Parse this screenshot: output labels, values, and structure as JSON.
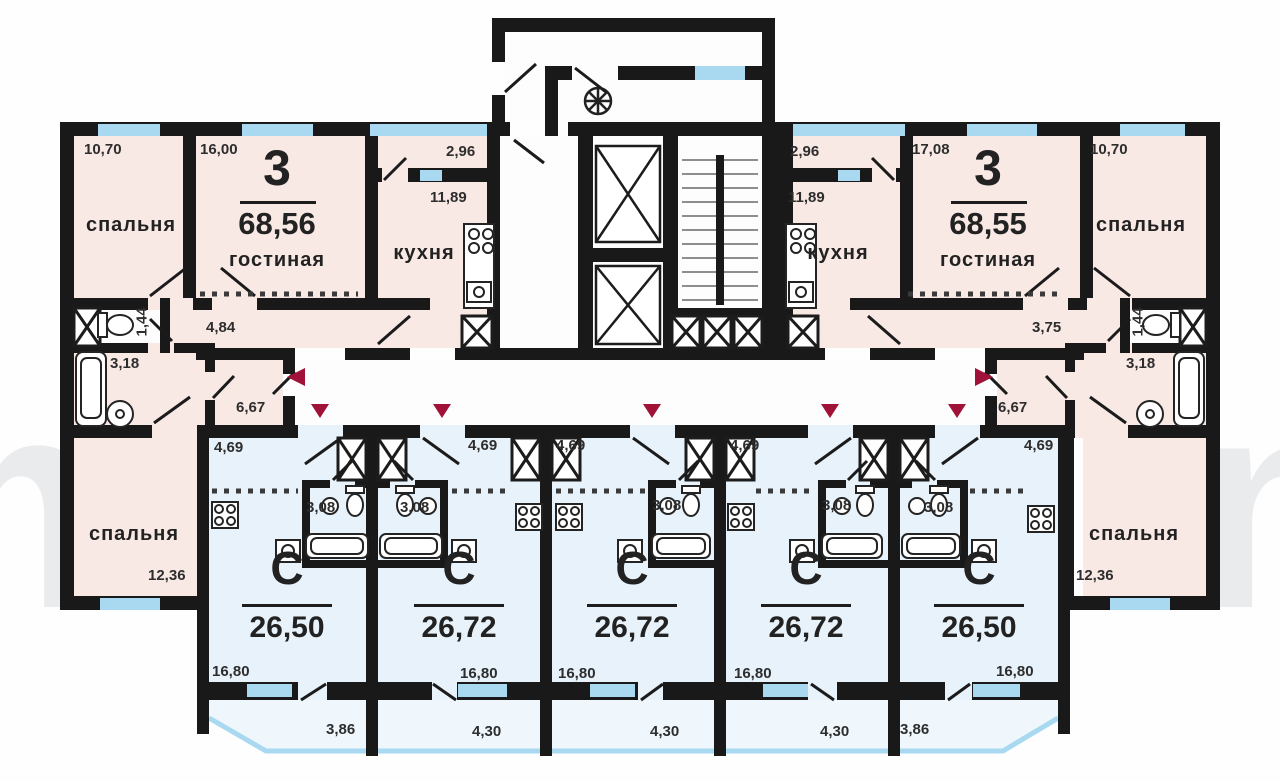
{
  "watermark": {
    "left": "m",
    "right": "n"
  },
  "colors": {
    "wall": "#191919",
    "apartment_fill": "#f9e9e5",
    "studio_fill": "#e8f2fa",
    "window": "#a8d9f1",
    "arrow": "#a01238"
  },
  "apartment_left": {
    "type": "3",
    "total_area": "68,56",
    "bedroom_top": {
      "name": "спальня",
      "area": "10,70"
    },
    "living": {
      "name": "гостиная",
      "area": "16,00"
    },
    "kitchen": {
      "name": "кухня",
      "area": "11,89"
    },
    "loggia_area": "2,96",
    "hall_area": "4,84",
    "wc_area": "1,44",
    "bath_area": "3,18",
    "corridor_area": "6,67",
    "bedroom_bottom": {
      "name": "спальня",
      "area": "12,36"
    }
  },
  "apartment_right": {
    "type": "3",
    "total_area": "68,55",
    "bedroom_top": {
      "name": "спальня",
      "area": "10,70"
    },
    "living": {
      "name": "гостиная",
      "area": "17,08"
    },
    "kitchen": {
      "name": "кухня",
      "area": "11,89"
    },
    "loggia_area": "2,96",
    "hall_area": "3,75",
    "wc_area": "1,44",
    "bath_area": "3,18",
    "corridor_area": "6,67",
    "bedroom_bottom": {
      "name": "спальня",
      "area": "12,36"
    }
  },
  "studios": [
    {
      "type": "С",
      "total_area": "26,50",
      "hall_area": "4,69",
      "bath_area": "3,08",
      "room_area": "16,80",
      "balcony_area": "3,86"
    },
    {
      "type": "С",
      "total_area": "26,72",
      "hall_area": "4,69",
      "bath_area": "3,08",
      "room_area": "16,80",
      "balcony_area": "4,30"
    },
    {
      "type": "С",
      "total_area": "26,72",
      "hall_area": "4,69",
      "bath_area": "3,08",
      "room_area": "16,80",
      "balcony_area": "4,30"
    },
    {
      "type": "С",
      "total_area": "26,72",
      "hall_area": "4,69",
      "bath_area": "3,08",
      "room_area": "16,80",
      "balcony_area": "4,30"
    },
    {
      "type": "С",
      "total_area": "26,50",
      "hall_area": "4,69",
      "bath_area": "3,08",
      "room_area": "16,80",
      "balcony_area": "3,86"
    }
  ]
}
